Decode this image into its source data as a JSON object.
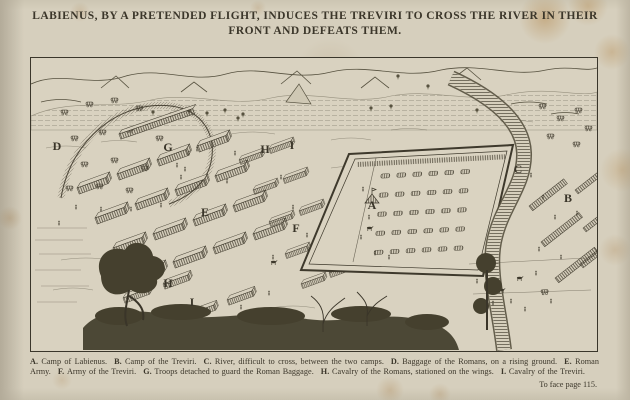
{
  "page": {
    "title_line1": "LABIENUS, BY A PRETENDED FLIGHT, INDUCES THE TREVIRI TO CROSS THE RIVER IN THEIR",
    "title_line2": "FRONT AND DEFEATS THEM.",
    "page_note": "To face page 115."
  },
  "colors": {
    "paper": "#d6cfbd",
    "ink": "#3b362a",
    "engraving_line": "#4a4436",
    "foxing": "#ad7a36"
  },
  "map": {
    "type": "engraved-battle-plan",
    "letters": [
      {
        "char": "D",
        "x": 26,
        "y": 88
      },
      {
        "char": "G",
        "x": 137,
        "y": 89
      },
      {
        "char": "H",
        "x": 234,
        "y": 91
      },
      {
        "char": "I",
        "x": 261,
        "y": 87
      },
      {
        "char": "E",
        "x": 174,
        "y": 154
      },
      {
        "char": "F",
        "x": 265,
        "y": 170
      },
      {
        "char": "A",
        "x": 341,
        "y": 147
      },
      {
        "char": "C",
        "x": 487,
        "y": 111
      },
      {
        "char": "B",
        "x": 537,
        "y": 140
      },
      {
        "char": "H",
        "x": 137,
        "y": 225
      },
      {
        "char": "I",
        "x": 161,
        "y": 244
      }
    ]
  },
  "legend": {
    "entries": [
      {
        "key": "A.",
        "text": "Camp of Labienus."
      },
      {
        "key": "B.",
        "text": "Camp of the Treviri."
      },
      {
        "key": "C.",
        "text": "River, difficult to cross, between the two camps."
      },
      {
        "key": "D.",
        "text": "Baggage of the Romans, on a rising ground."
      },
      {
        "key": "E.",
        "text": "Roman Army."
      },
      {
        "key": "F.",
        "text": "Army of the Treviri."
      },
      {
        "key": "G.",
        "text": "Troops detached to guard the Roman Baggage."
      },
      {
        "key": "H.",
        "text": "Cavalry of the Romans, stationed on the wings."
      },
      {
        "key": "I.",
        "text": "Cavalry of the Treviri."
      }
    ]
  }
}
